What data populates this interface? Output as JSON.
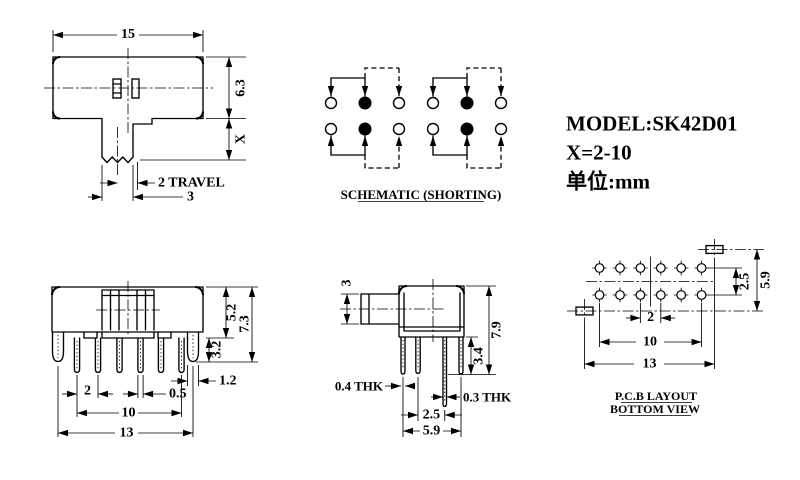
{
  "title_block": {
    "model": "MODEL:SK42D01",
    "x_range": "X=2-10",
    "units": "单位:mm"
  },
  "top_view": {
    "dim_width": "15",
    "dim_height": "6.3",
    "dim_stem": "X",
    "dim_travel": "2 TRAVEL",
    "dim_knob": "3"
  },
  "schematic": {
    "caption": "SCHEMATIC (SHORTING)"
  },
  "front_view": {
    "dim_body_h": "5.2",
    "dim_total_h": "7.3",
    "dim_pin_len": "3.2",
    "dim_lug_w": "1.2",
    "dim_pitch": "2",
    "dim_pin_w": "0.5",
    "dim_span": "10",
    "dim_lug_span": "13"
  },
  "side_view": {
    "dim_knob_h": "3",
    "dim_total_h": "7.9",
    "dim_pin_len": "3.4",
    "dim_lug_thk": "0.4 THK",
    "dim_pin_thk": "0.3 THK",
    "dim_row_pitch": "2.5",
    "dim_lug_pitch": "5.9"
  },
  "pcb_layout": {
    "caption_line1": "P.C.B LAYOUT",
    "caption_line2": "BOTTOM VIEW",
    "dim_row_pitch": "2.5",
    "dim_pad_pitch": "5.9",
    "dim_hole_pitch": "2",
    "dim_hole_span": "10",
    "dim_pad_span": "13"
  },
  "colors": {
    "ink": "#000000",
    "paper": "#ffffff"
  }
}
